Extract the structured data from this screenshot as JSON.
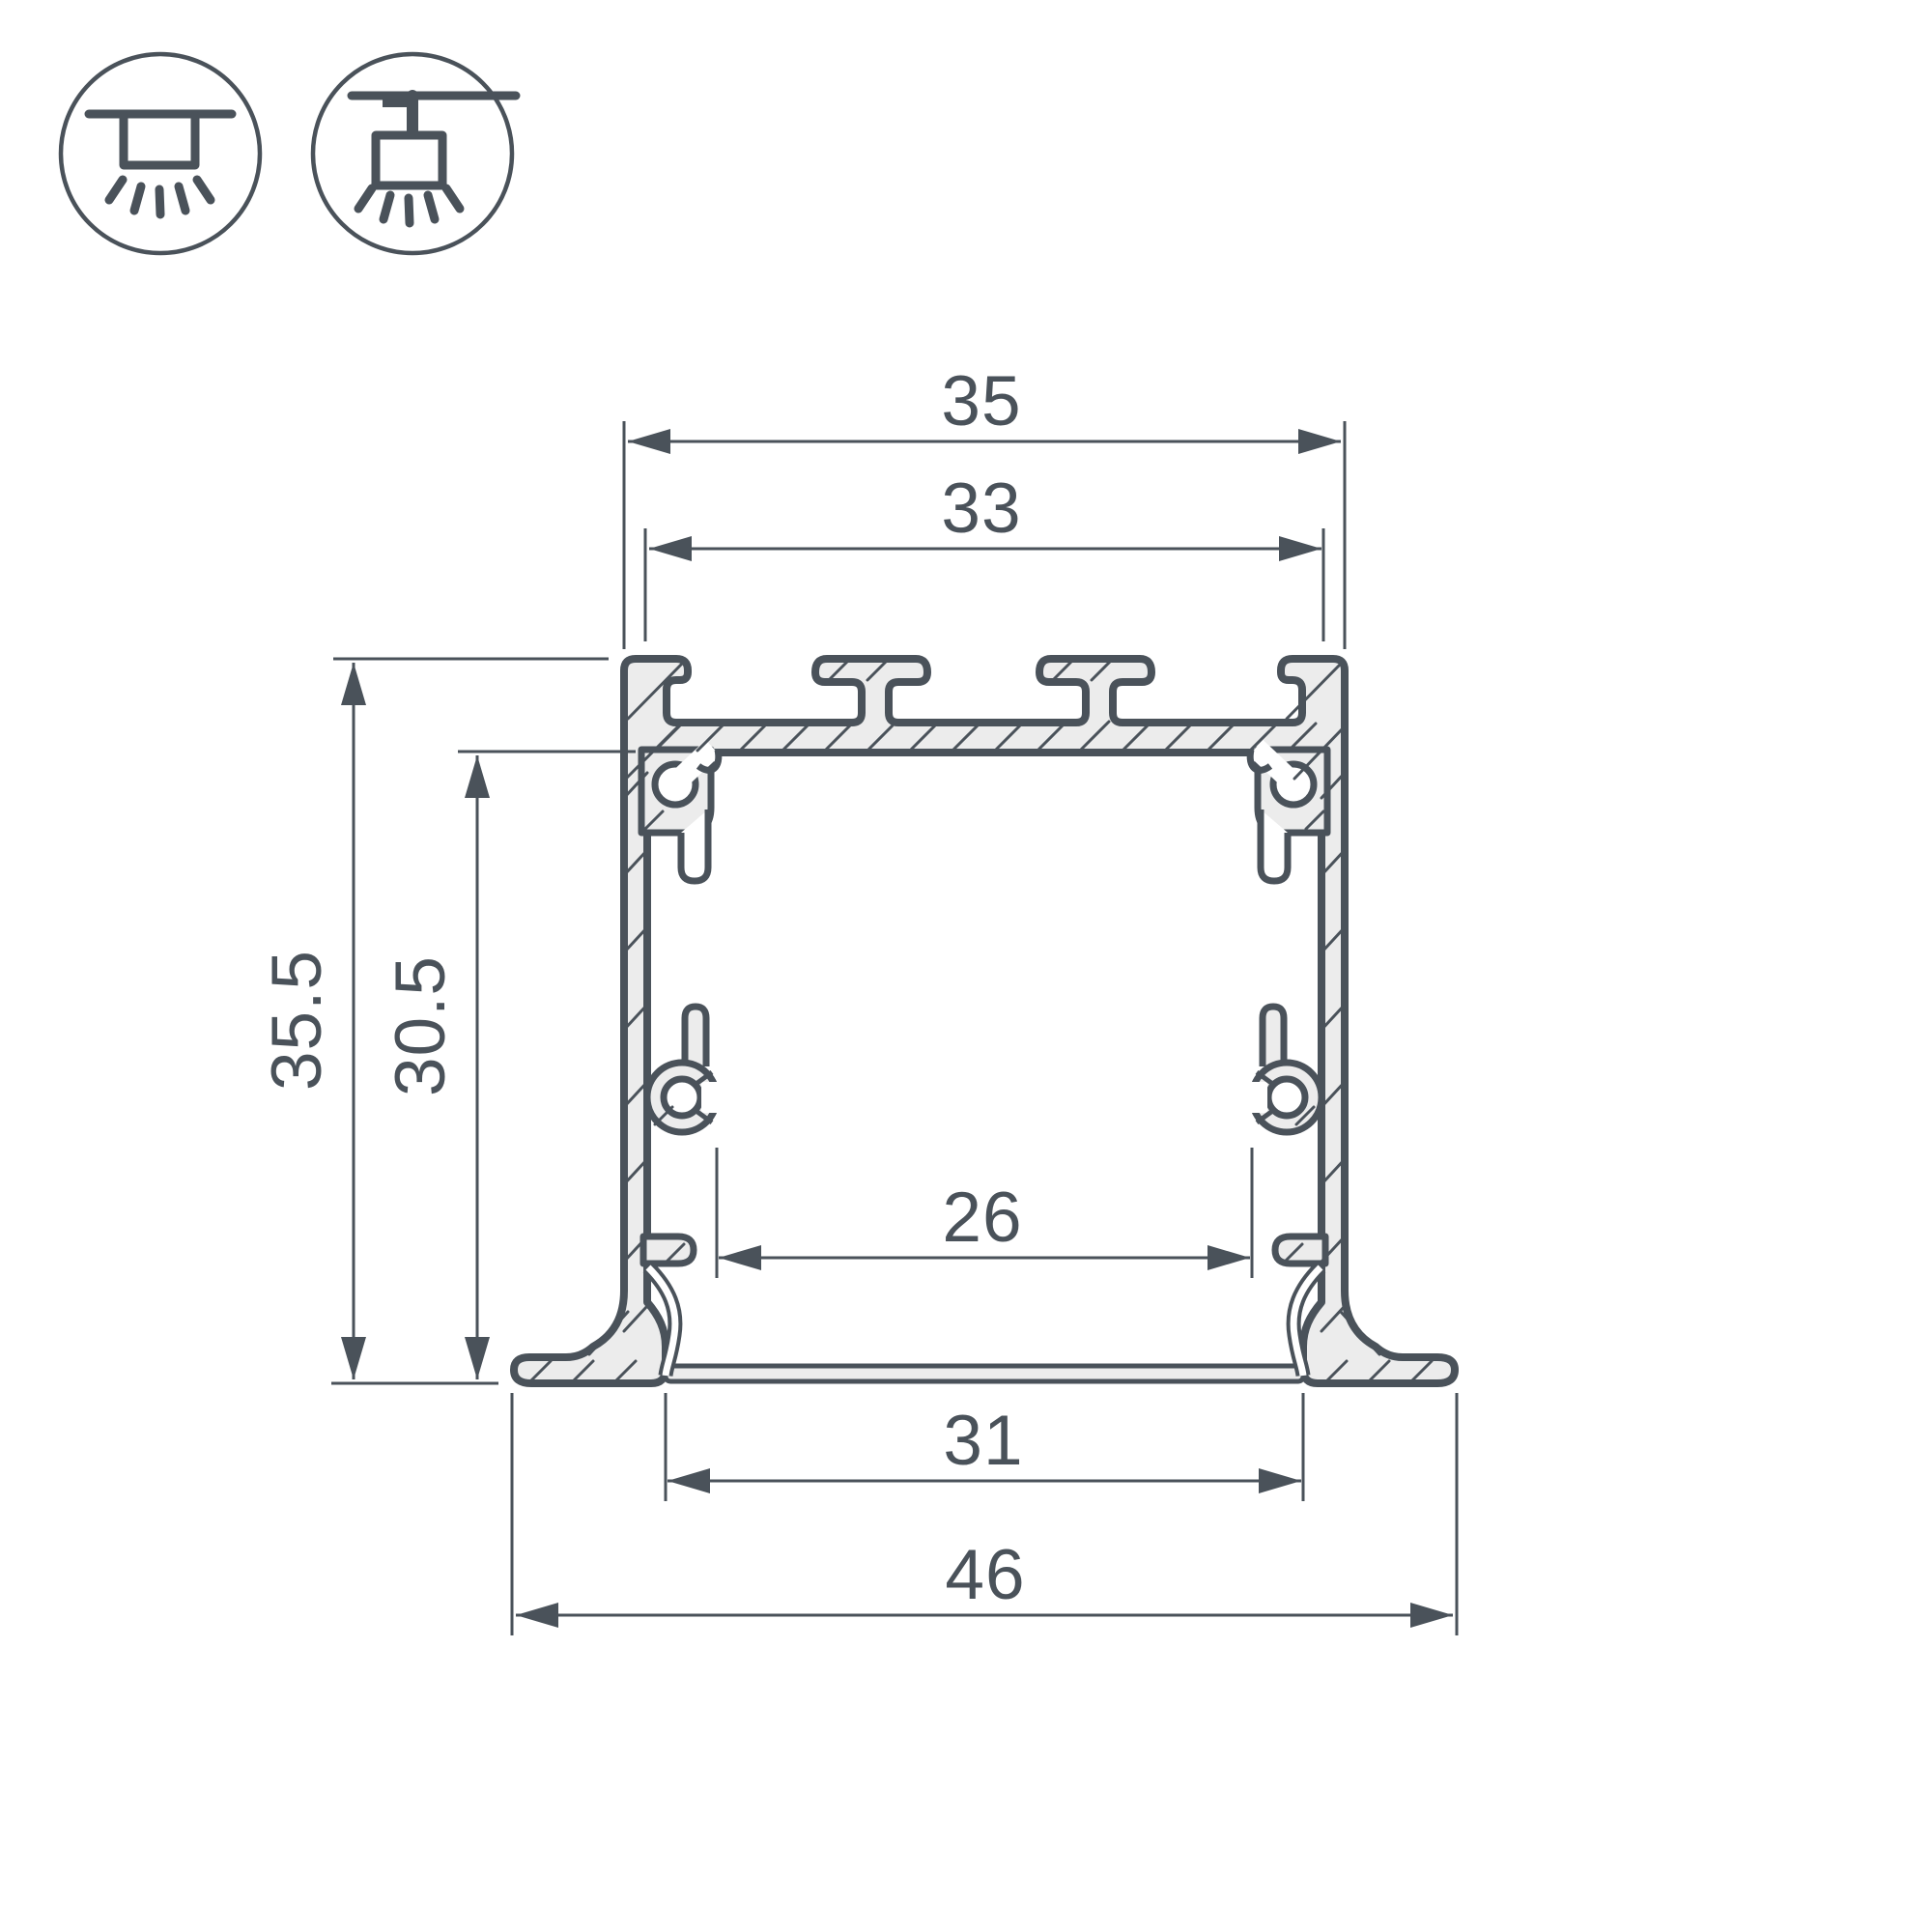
{
  "drawing": {
    "type": "technical-cross-section",
    "subject": "recessed aluminium LED profile cross-section with dimensions",
    "background_color": "#ffffff",
    "line_color": "#4a525a",
    "material_fill_color": "#ececec",
    "dimensions": {
      "top_outer_width": "35",
      "top_inner_width": "33",
      "overall_height": "35.5",
      "inner_height": "30.5",
      "inner_clear_width": "26",
      "base_inner_width": "31",
      "flange_overall_width": "46"
    },
    "mount_icons": [
      {
        "name": "recessed-mount-icon",
        "meaning": "recessed ceiling mounting, light downward"
      },
      {
        "name": "surface-mount-icon",
        "meaning": "surface ceiling mounting, light downward"
      }
    ]
  }
}
